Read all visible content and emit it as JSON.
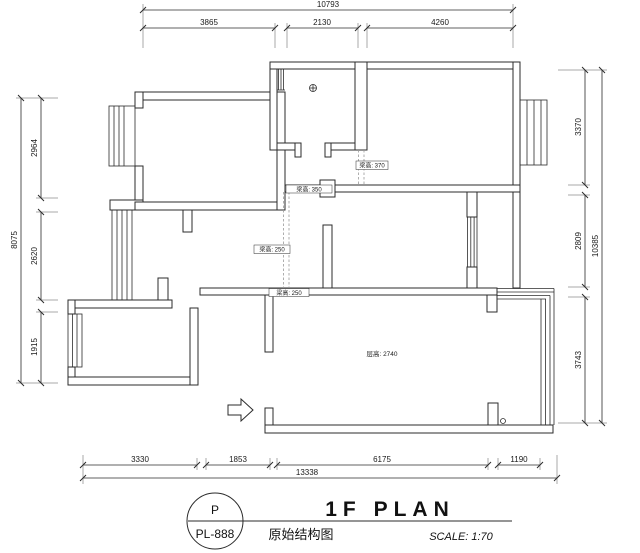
{
  "dimensions": {
    "top": {
      "overall": "10793",
      "segments": [
        "3865",
        "2130",
        "4260"
      ]
    },
    "left": {
      "overall": "8075",
      "segments": [
        "2964",
        "2620",
        "1915"
      ]
    },
    "right": {
      "overall": "10385",
      "segments": [
        "3370",
        "2809",
        "3743"
      ]
    },
    "bottom": {
      "overall": "13338",
      "segments": [
        "3330",
        "1853",
        "6175",
        "1190"
      ]
    }
  },
  "annotations": {
    "beam_370": "梁高: 370",
    "beam_350": "梁高: 350",
    "beam_250_a": "梁高: 250",
    "beam_250_b": "梁高: 250",
    "ceiling_height": "层高: 2740"
  },
  "title_block": {
    "sheet_letter": "P",
    "sheet_number": "PL-888",
    "plan_title": "1F PLAN",
    "drawing_name": "原始结构图",
    "scale_label": "SCALE: 1:70"
  },
  "colors": {
    "line": "#2b2b2b",
    "background": "#ffffff",
    "beam_dash": "#9a9a9a"
  }
}
